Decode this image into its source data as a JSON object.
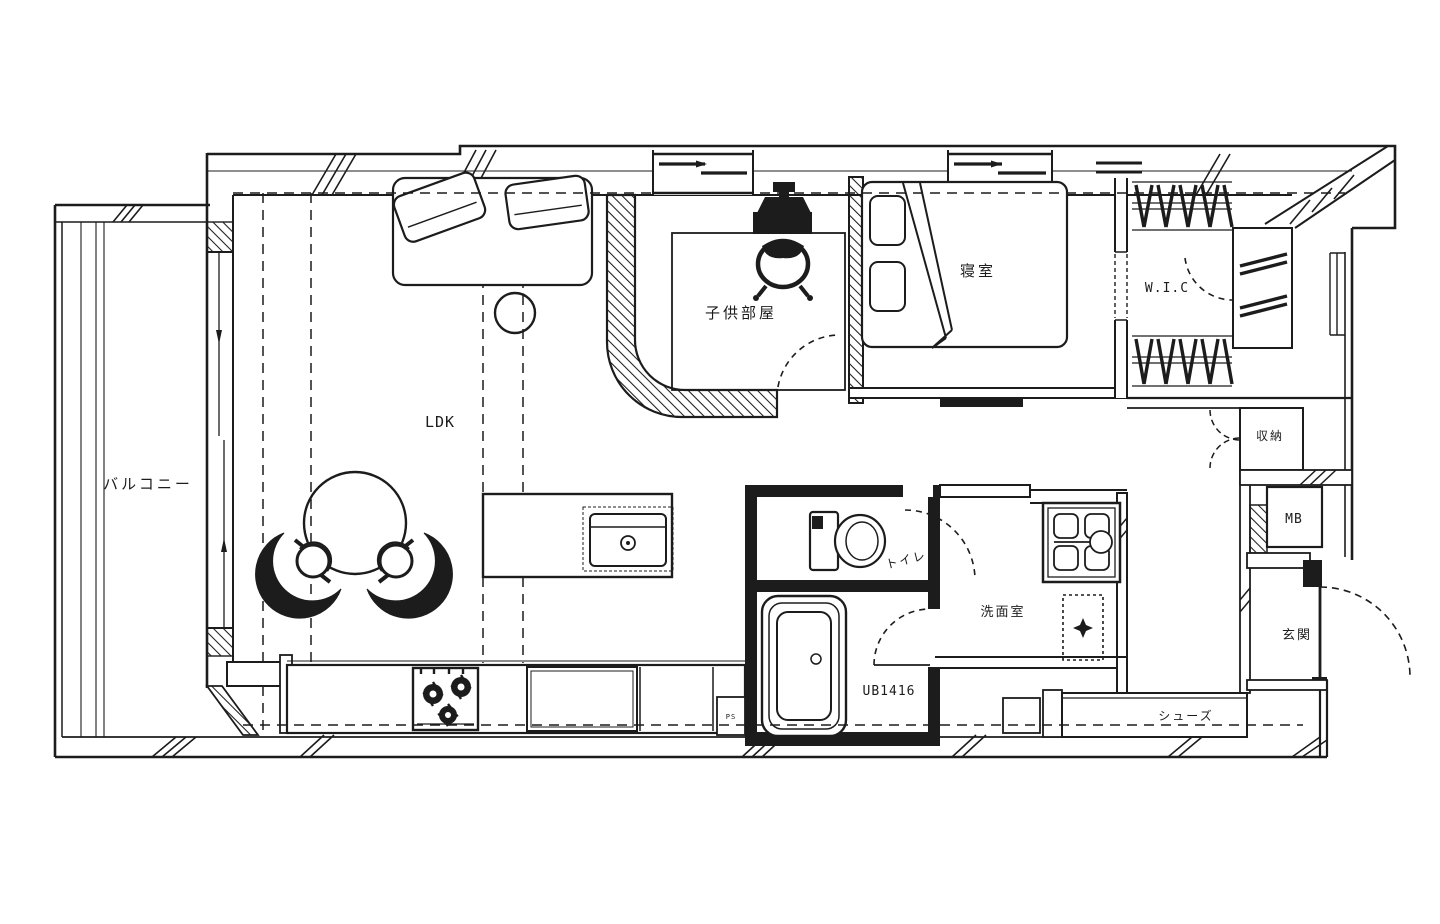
{
  "floorplan": {
    "labels": {
      "balcony": "バルコニー",
      "ldk": "LDK",
      "kids_room": "子供部屋",
      "bedroom": "寝室",
      "wic": "W.I.C",
      "storage": "収納",
      "meter_box": "MB",
      "toilet": "トイレ",
      "washroom": "洗面室",
      "unit_bath": "UB1416",
      "entrance": "玄関",
      "shoe_rack": "シューズ",
      "pipe_space": "PS"
    },
    "colors": {
      "ink": "#1c1c1c",
      "paper": "#ffffff"
    }
  }
}
